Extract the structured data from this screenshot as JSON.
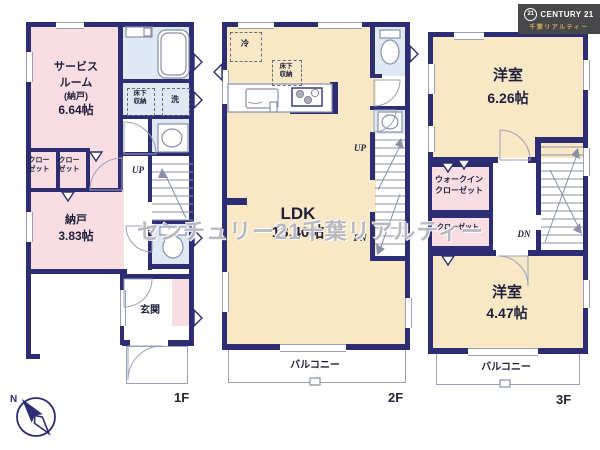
{
  "logo": {
    "badge": "21",
    "brand": "CENTURY 21",
    "subtitle": "千葉リアルティー"
  },
  "watermark": "センチュリー21千葉リアルティー",
  "compass": {
    "north": "N"
  },
  "terms": {
    "up": "UP",
    "dn": "DN",
    "balcony": "バルコニー",
    "closet_l1": "クロー",
    "closet_l2": "ゼット",
    "closet": "クローゼット",
    "underfloor_l1": "床下",
    "underfloor_l2": "収納",
    "fridge": "冷",
    "laundry": "洗",
    "entrance": "玄関"
  },
  "floor1": {
    "label": "1F",
    "service_room": {
      "l1": "サービス",
      "l2": "ルーム",
      "l3": "(納戸)",
      "size": "6.64帖"
    },
    "storage": {
      "name": "納戸",
      "size": "3.83帖"
    }
  },
  "floor2": {
    "label": "2F",
    "ldk": {
      "name": "LDK",
      "size": "18.40帖"
    }
  },
  "floor3": {
    "label": "3F",
    "bedroom1": {
      "name": "洋室",
      "size": "6.26帖"
    },
    "bedroom2": {
      "name": "洋室",
      "size": "4.47帖"
    },
    "wic": {
      "l1": "ウォークイン",
      "l2": "クローゼット"
    }
  },
  "colors": {
    "wall": "#2d2d73",
    "room_pink": "#f8dee3",
    "room_yellow": "#f8e8c6",
    "room_blue": "#dfe9f3",
    "logo_bg": "#48484a",
    "logo_gold": "#d2aa5e"
  }
}
